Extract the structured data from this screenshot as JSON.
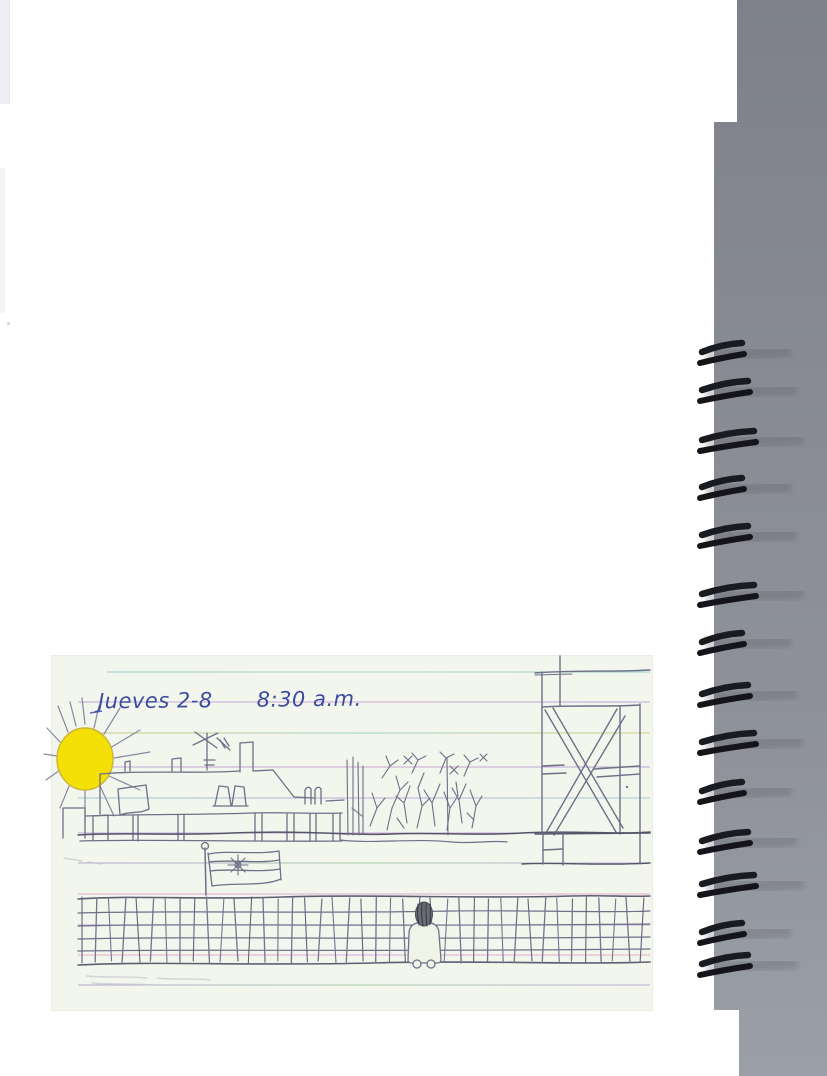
{
  "scan": {
    "caption": {
      "date": "Jueves 2-8",
      "time": "8:30 a.m."
    },
    "drawing_elements": [
      "sun",
      "tv-antenna",
      "rooftops-with-chimneys",
      "small-flag",
      "low-wall",
      "star-flag-on-pole",
      "bare-bush",
      "cross-braced-tower",
      "ground-line",
      "chain-link-fence",
      "child-at-fence"
    ],
    "palette": {
      "sun_yellow": "#f4e006",
      "ink_blue": "#3c4b9e",
      "pencil_gray": "#6f6f88",
      "card_paper": "#f3f6ec",
      "page_white": "#ffffff",
      "scanner_gray": "#8b8e96",
      "coil_black": "#1a1a21",
      "rule_cyan": "#7fc9cc",
      "rule_violet": "#b49ad8",
      "rule_pink": "#e59ec6",
      "rule_olive": "#c6ca6c"
    }
  }
}
